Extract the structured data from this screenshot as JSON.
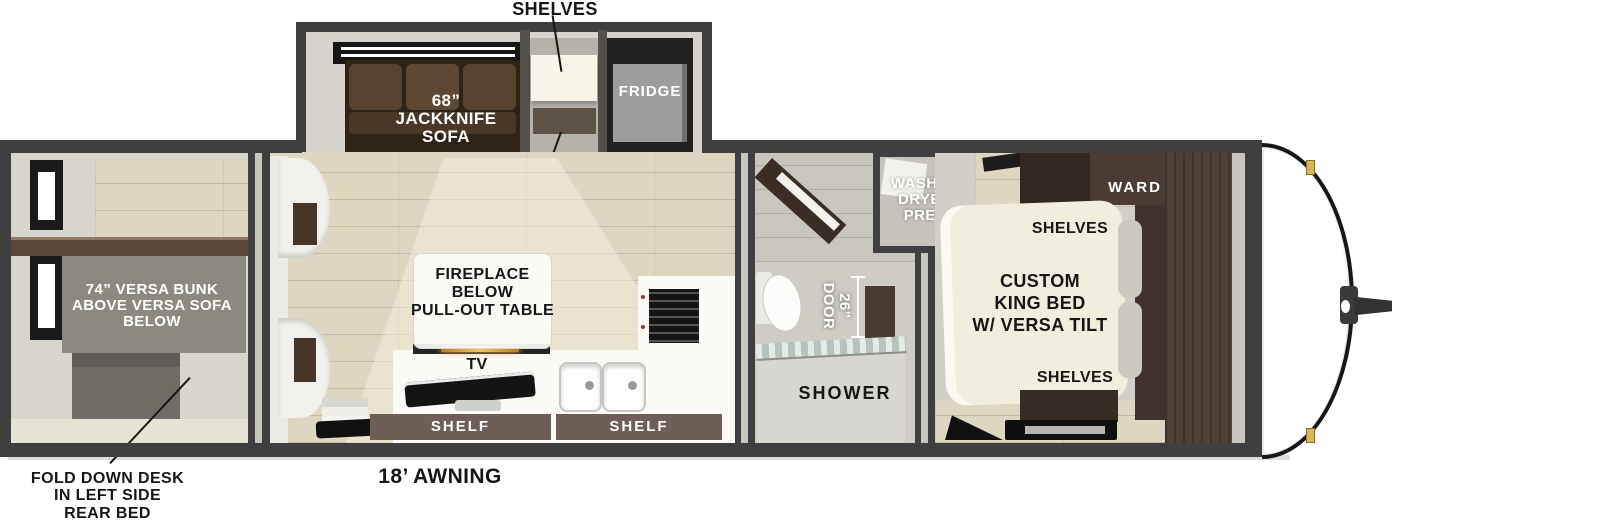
{
  "figure": {
    "type": "rv-travel-trailer-floorplan",
    "awning_label": "18’ AWNING"
  },
  "slideout": {
    "shelves_callout": "SHELVES",
    "sofa_lines": [
      "68”",
      "JACKKNIFE",
      "SOFA"
    ],
    "fridge_label": "FRIDGE",
    "closet_lines": [
      "CLOSET/",
      "PANTRY"
    ]
  },
  "rear_bedroom": {
    "bunk_lines": [
      "74” VERSA BUNK",
      "ABOVE VERSA SOFA",
      "BELOW"
    ],
    "desk_callout_lines": [
      "FOLD DOWN DESK",
      "IN LEFT SIDE",
      "REAR BED"
    ]
  },
  "living": {
    "fireplace_lines": [
      "FIREPLACE",
      "BELOW",
      "PULL-OUT TABLE"
    ],
    "tv_label": "TV",
    "shelf_left_label": "SHELF",
    "shelf_right_label": "SHELF"
  },
  "bath": {
    "washer_lines": [
      "WASHER",
      "DRYER",
      "PREP"
    ],
    "door_lines": [
      "26”",
      "DOOR"
    ],
    "shower_label": "SHOWER"
  },
  "front_bedroom": {
    "ward_label": "WARD",
    "shelves_top_label": "SHELVES",
    "bed_lines": [
      "CUSTOM",
      "KING BED",
      "W/ VERSA TILT"
    ],
    "shelves_bottom_label": "SHELVES"
  },
  "colors": {
    "wall_dark": "#3f3e40",
    "wall_light": "#d6d3cb",
    "floor_tan": "#ddd6c1",
    "sofa_brown": "#57432e",
    "wardrobe_brown": "#4b3c33",
    "shelf_brown": "#6f5e56",
    "bed_cream": "#f2eedd",
    "fridge_gray": "#9d9da0",
    "accent_clip_yellow": "#d9b557",
    "text_dark": "#161616",
    "text_light": "#ffffff"
  }
}
